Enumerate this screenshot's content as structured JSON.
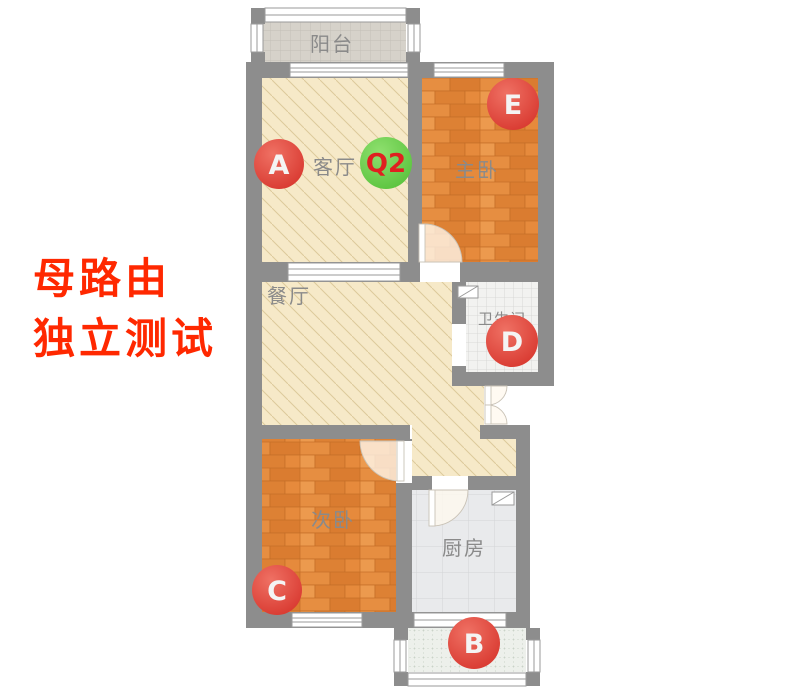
{
  "annotation": {
    "line1": "母路由",
    "line2": "独立测试"
  },
  "rooms": {
    "balcony_top": {
      "label": "阳台"
    },
    "living": {
      "label": "客厅"
    },
    "master": {
      "label": "主卧"
    },
    "dining": {
      "label": "餐厅"
    },
    "bathroom": {
      "label": "卫生间"
    },
    "bedroom2": {
      "label": "次卧"
    },
    "kitchen": {
      "label": "厨房"
    }
  },
  "markers": {
    "a": {
      "label": "A"
    },
    "q2": {
      "label": "Q2"
    },
    "e": {
      "label": "E"
    },
    "d": {
      "label": "D"
    },
    "c": {
      "label": "C"
    },
    "b": {
      "label": "B"
    }
  },
  "colors": {
    "marker_red": "#df4238",
    "marker_green": "#6ccf4f",
    "q2_text": "#e02020",
    "annotation_red": "#ff2800",
    "wall_gray": "#8d8d8d",
    "label_gray": "#8a8a8a",
    "floor_cream": "#f6e9c8",
    "floor_wood": "#e08638",
    "floor_bath_tile": "#f2f2f0",
    "floor_kitchen_tile": "#e9eaec"
  }
}
